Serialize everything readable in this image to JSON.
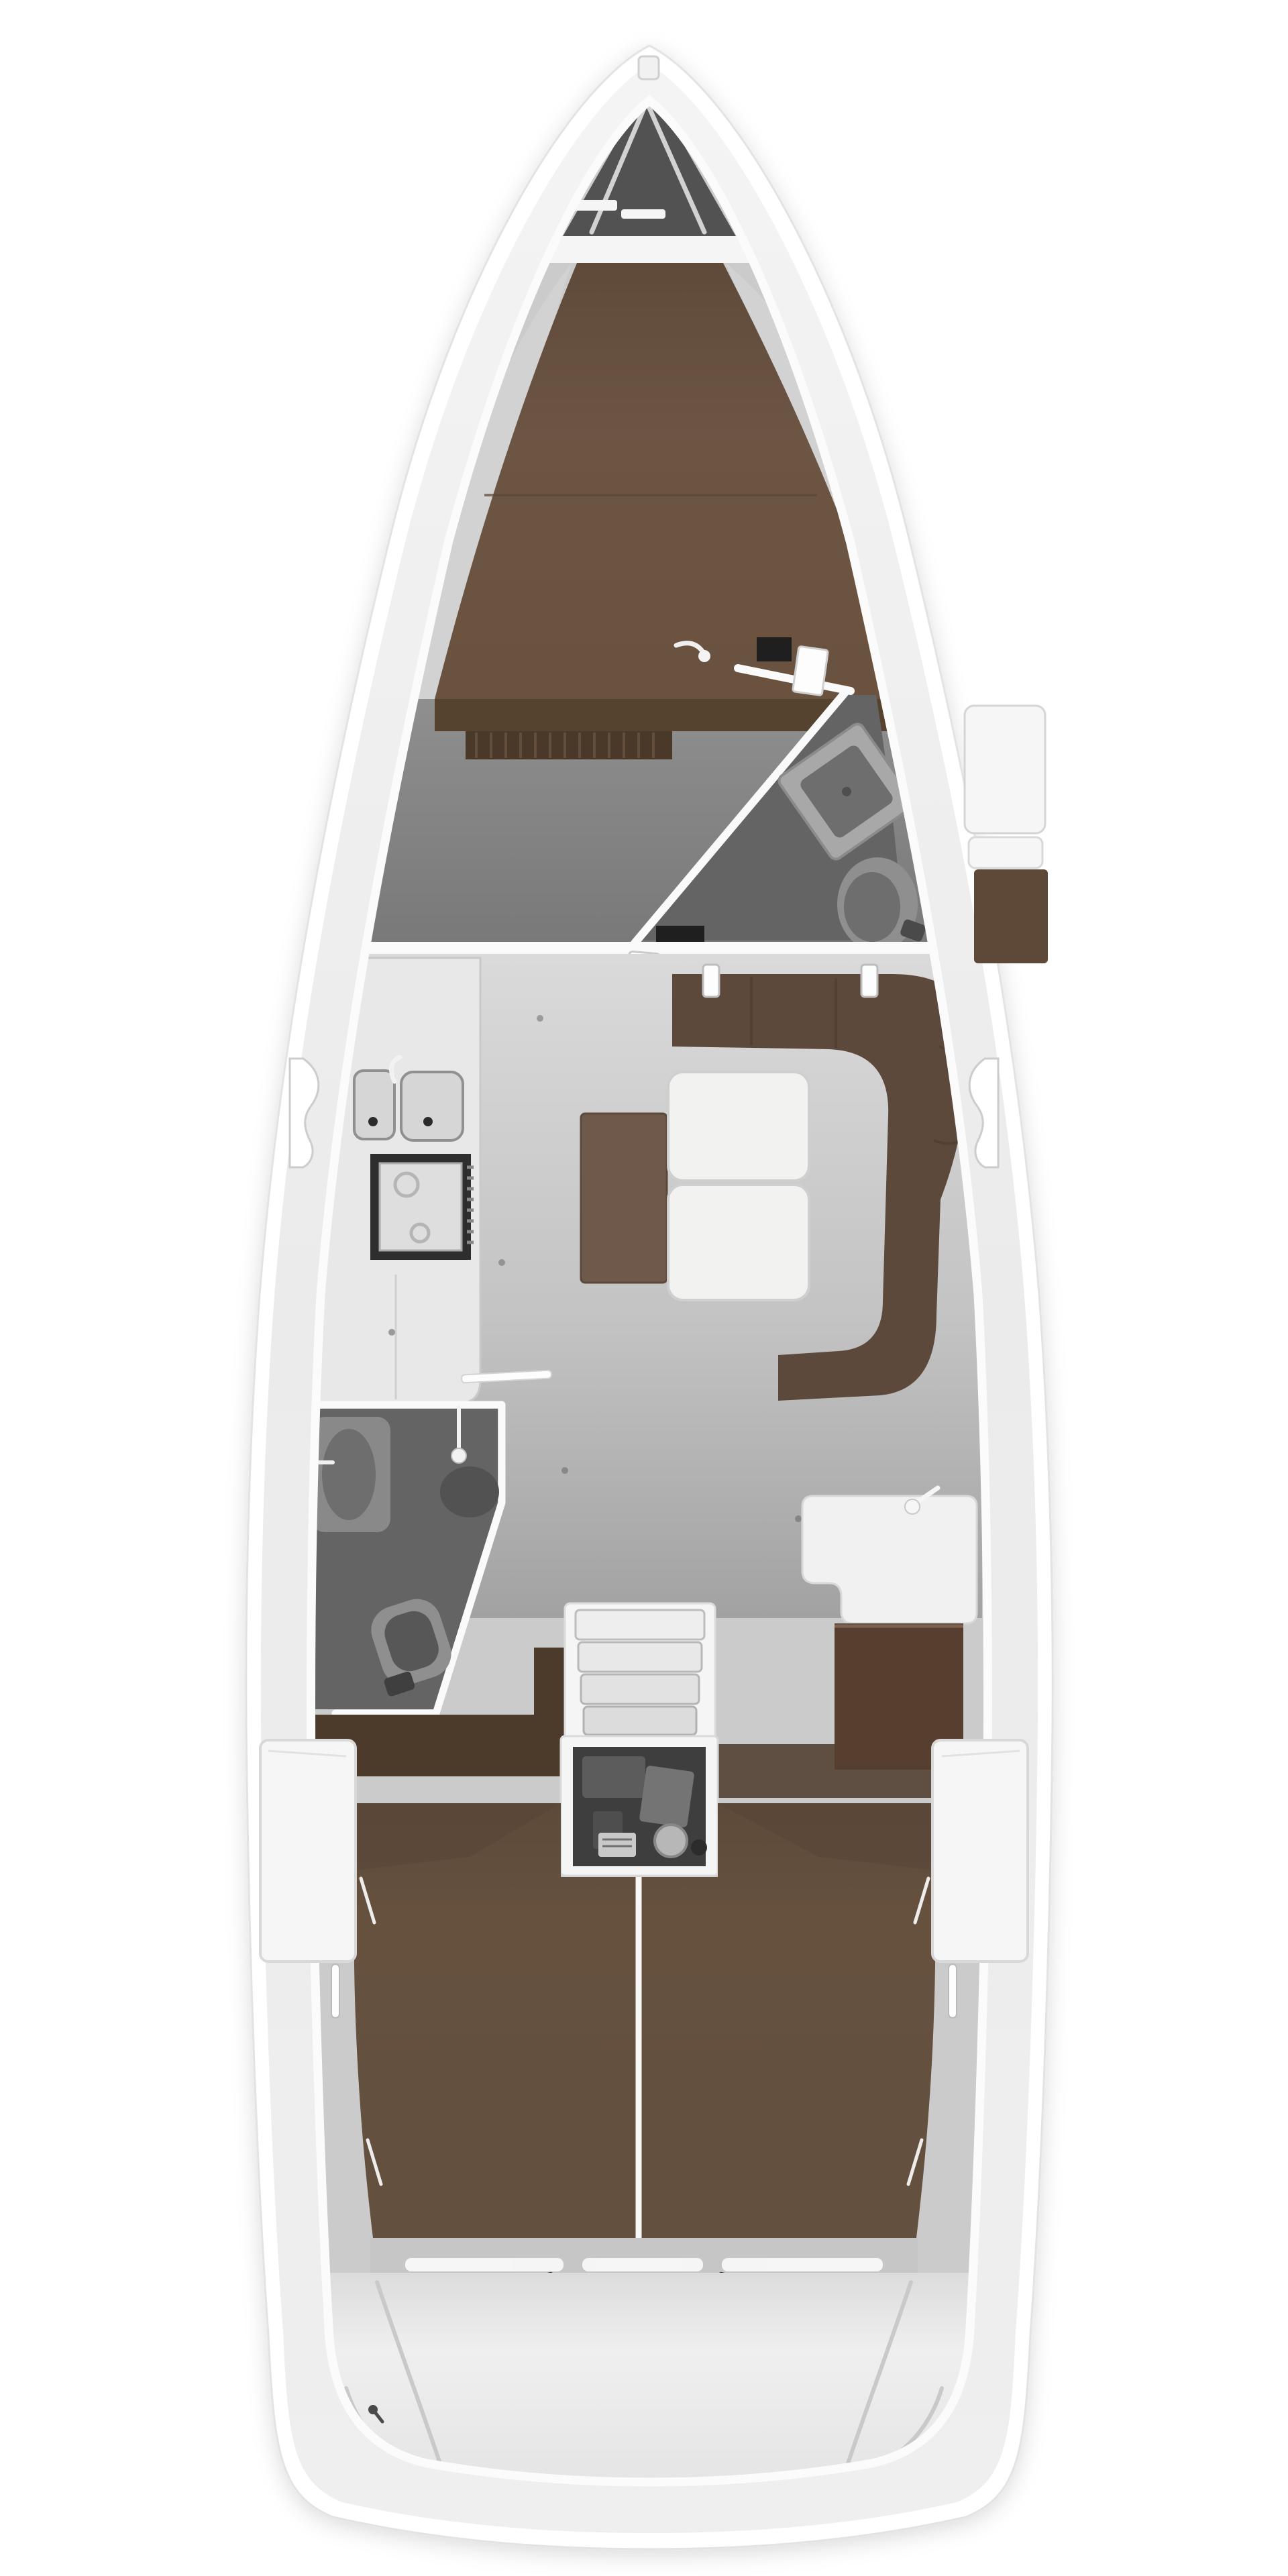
{
  "diagram": {
    "kind": "yacht-interior-floor-plan",
    "orientation": "bow-up",
    "rooms": [
      {
        "id": "anchor-locker",
        "position": "bow"
      },
      {
        "id": "forward-cabin-v-berth",
        "position": "fore"
      },
      {
        "id": "forward-head",
        "position": "starboard-fore"
      },
      {
        "id": "galley",
        "position": "port-midship"
      },
      {
        "id": "salon-settee",
        "position": "starboard-midship"
      },
      {
        "id": "aft-head",
        "position": "port-aft"
      },
      {
        "id": "nav-station",
        "position": "starboard-aft"
      },
      {
        "id": "companionway-engine",
        "position": "center-aft"
      },
      {
        "id": "aft-berth",
        "position": "aft"
      },
      {
        "id": "transom",
        "position": "stern"
      }
    ]
  },
  "colors": {
    "hull": "#ffffff",
    "hull_edge": "#e3e3e3",
    "deck_band": "#ececec",
    "gunwale": "#fbfbfb",
    "interior_base": "#cbcbcb",
    "anchor_locker": "#525252",
    "anchor_chain": "#d2d2d2",
    "anchor_bulkhead": "#f5f5f5",
    "windlass": "#2d2d2d",
    "v_berth": "#6d5544",
    "berth_seam": "#5c4737",
    "bed_board": "#55422f",
    "louver": "#4a3828",
    "louver_stripe": "#6a5340",
    "cabin_floor": "#868686",
    "head_floor": "#646464",
    "bulkhead": "#fafafa",
    "doorway_dark": "#1f1f1f",
    "fixture_light": "#a8a8a8",
    "fixture_mid": "#8f8f8f",
    "fixture_dark": "#6e6e6e",
    "fixture_deep": "#575757",
    "galley_counter": "#e8e8e8",
    "galley_edge": "#c9c9c9",
    "sink": "#d6d6d6",
    "sink_edge": "#909090",
    "drain": "#2b2b2b",
    "stove_frame": "#2e2e2e",
    "stove_top": "#dedede",
    "settee": "#5d493b",
    "table": "#f2f2f1",
    "table_edge": "#cfcfcf",
    "pouf": "#6f594a",
    "nav_seat": "#f1f1f1",
    "chart_table": "#573f30",
    "wood_floor": "#4c3a2b",
    "step_frame": "#f5f5f5",
    "step_tread": "#ececec",
    "engine_bay": "#3e3e3e",
    "engine_part": "#5c5c5c",
    "engine_part2": "#747474",
    "engine_metal": "#b7b7b7",
    "aft_berth": "#64503f",
    "berth_divider": "#f7f7f7",
    "wardrobe": "#f6f6f6",
    "wardrobe_edge": "#d8d8d8",
    "foot_shelf": "#c6c6c6",
    "shelf_highlight": "#fafafa",
    "hinge": "#3a3a3a",
    "stern_line": "#c9c9c9",
    "white_fitting": "#fdfdfd",
    "shelf_wedge": "#d2d2d2",
    "floor_dot": "#555555",
    "locker_brown": "#5e4837",
    "shadow_brown": "#574536"
  }
}
